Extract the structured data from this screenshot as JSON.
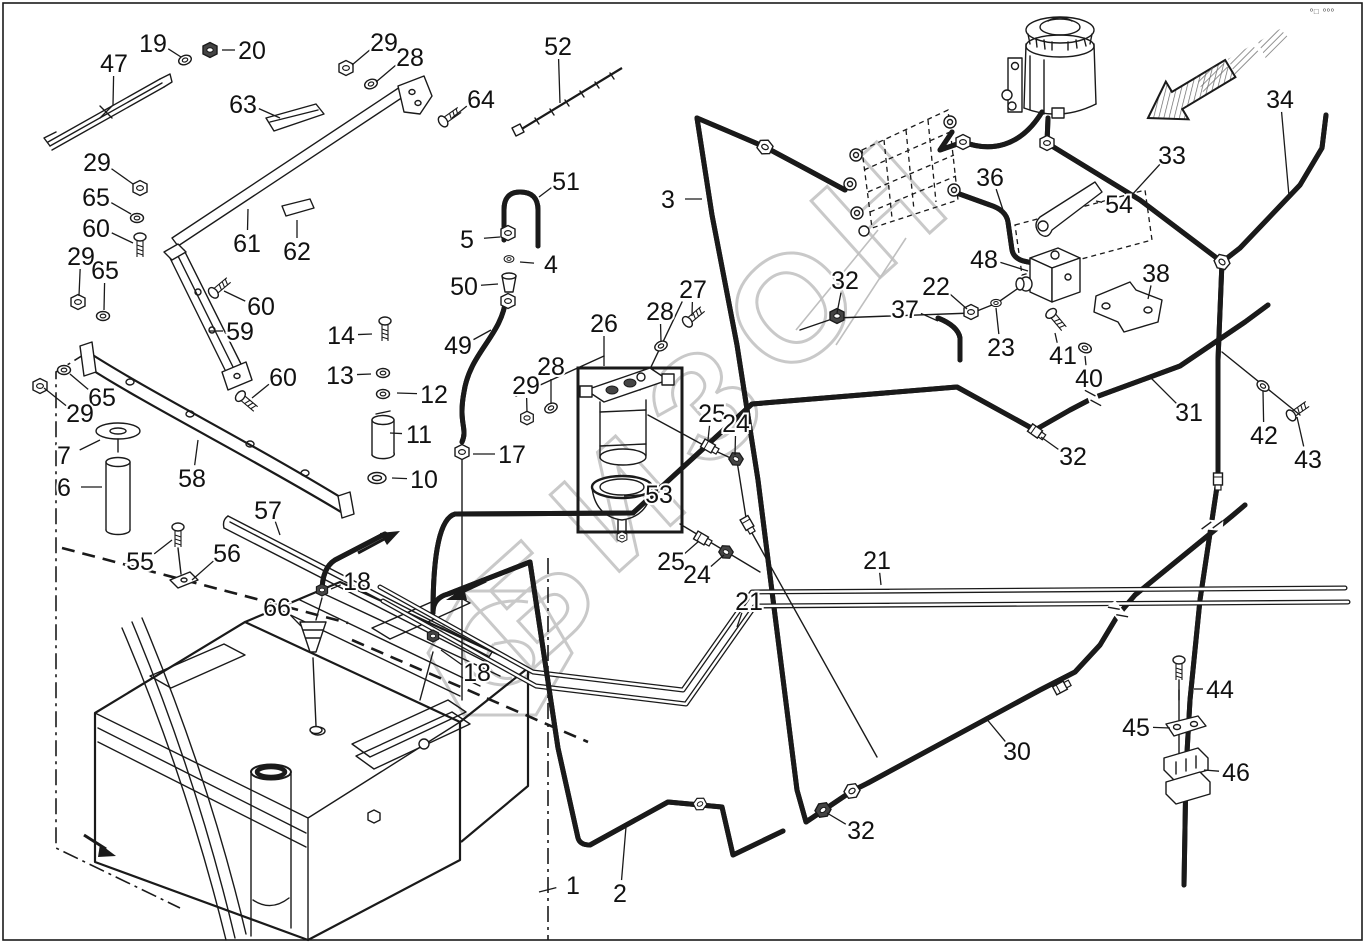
{
  "meta": {
    "watermark_text": "БИЗОН",
    "corner_mark": "º□ ººº",
    "diagram_type": "exploded-parts-diagram",
    "subject": "fuel-tank-and-hydraulic-lines"
  },
  "colors": {
    "line": "#1a1a1a",
    "watermark": "#c9c9c9",
    "background": "#ffffff"
  },
  "callouts": [
    {
      "label": "19",
      "x": 153,
      "y": 43,
      "tx": 181,
      "ty": 57
    },
    {
      "label": "20",
      "x": 252,
      "y": 50,
      "tx": 222,
      "ty": 50
    },
    {
      "label": "47",
      "x": 114,
      "y": 63,
      "tx": 113,
      "ty": 105
    },
    {
      "label": "29",
      "x": 384,
      "y": 42,
      "tx": 352,
      "ty": 65
    },
    {
      "label": "28",
      "x": 410,
      "y": 57,
      "tx": 376,
      "ty": 82
    },
    {
      "label": "63",
      "x": 243,
      "y": 104,
      "tx": 280,
      "ty": 118
    },
    {
      "label": "64",
      "x": 481,
      "y": 99,
      "tx": 452,
      "ty": 118
    },
    {
      "label": "52",
      "x": 558,
      "y": 46,
      "tx": 560,
      "ty": 103
    },
    {
      "label": "34",
      "x": 1280,
      "y": 99,
      "tx": 1289,
      "ty": 196
    },
    {
      "label": "33",
      "x": 1172,
      "y": 155,
      "tx": 1130,
      "ty": 197
    },
    {
      "label": "36",
      "x": 990,
      "y": 177,
      "tx": 1004,
      "ty": 213
    },
    {
      "label": "54",
      "x": 1119,
      "y": 204,
      "tx": 1096,
      "ty": 201
    },
    {
      "label": "3",
      "x": 668,
      "y": 199,
      "tx": 702,
      "ty": 199
    },
    {
      "label": "29",
      "x": 97,
      "y": 162,
      "tx": 133,
      "ty": 184
    },
    {
      "label": "65",
      "x": 96,
      "y": 197,
      "tx": 131,
      "ty": 214
    },
    {
      "label": "60",
      "x": 96,
      "y": 228,
      "tx": 133,
      "ty": 243
    },
    {
      "label": "29",
      "x": 81,
      "y": 256,
      "tx": 79,
      "ty": 296
    },
    {
      "label": "65",
      "x": 105,
      "y": 270,
      "tx": 104,
      "ty": 310
    },
    {
      "label": "60",
      "x": 261,
      "y": 306,
      "tx": 224,
      "ty": 291
    },
    {
      "label": "59",
      "x": 240,
      "y": 331,
      "tx": 209,
      "ty": 331
    },
    {
      "label": "60",
      "x": 283,
      "y": 377,
      "tx": 252,
      "ty": 398
    },
    {
      "label": "61",
      "x": 247,
      "y": 243,
      "tx": 248,
      "ty": 209
    },
    {
      "label": "62",
      "x": 297,
      "y": 251,
      "tx": 297,
      "ty": 220
    },
    {
      "label": "5",
      "x": 467,
      "y": 239,
      "tx": 500,
      "ty": 237
    },
    {
      "label": "4",
      "x": 551,
      "y": 264,
      "tx": 520,
      "ty": 262
    },
    {
      "label": "50",
      "x": 464,
      "y": 286,
      "tx": 498,
      "ty": 284
    },
    {
      "label": "49",
      "x": 458,
      "y": 345,
      "tx": 491,
      "ty": 330
    },
    {
      "label": "51",
      "x": 566,
      "y": 181,
      "tx": 539,
      "ty": 197
    },
    {
      "label": "14",
      "x": 341,
      "y": 335,
      "tx": 372,
      "ty": 334
    },
    {
      "label": "13",
      "x": 340,
      "y": 375,
      "tx": 371,
      "ty": 374
    },
    {
      "label": "12",
      "x": 434,
      "y": 394,
      "tx": 397,
      "ty": 393
    },
    {
      "label": "11",
      "x": 419,
      "y": 434,
      "tx": 390,
      "ty": 433
    },
    {
      "label": "10",
      "x": 424,
      "y": 479,
      "tx": 392,
      "ty": 478
    },
    {
      "label": "17",
      "x": 512,
      "y": 454,
      "tx": 473,
      "ty": 454
    },
    {
      "label": "26",
      "x": 604,
      "y": 323,
      "tx": 604,
      "ty": 366
    },
    {
      "label": "28",
      "x": 660,
      "y": 311,
      "tx": 661,
      "ty": 342
    },
    {
      "label": "27",
      "x": 693,
      "y": 289,
      "tx": 692,
      "ty": 316
    },
    {
      "label": "29",
      "x": 526,
      "y": 385,
      "tx": 527,
      "ty": 412
    },
    {
      "label": "28",
      "x": 551,
      "y": 366,
      "tx": 551,
      "ty": 404
    },
    {
      "label": "65",
      "x": 102,
      "y": 397,
      "tx": 70,
      "ty": 374
    },
    {
      "label": "29",
      "x": 80,
      "y": 413,
      "tx": 44,
      "ty": 388
    },
    {
      "label": "7",
      "x": 64,
      "y": 455,
      "tx": 100,
      "ty": 440
    },
    {
      "label": "6",
      "x": 64,
      "y": 487,
      "tx": 102,
      "ty": 487
    },
    {
      "label": "58",
      "x": 192,
      "y": 478,
      "tx": 198,
      "ty": 440
    },
    {
      "label": "57",
      "x": 268,
      "y": 510,
      "tx": 280,
      "ty": 535
    },
    {
      "label": "55",
      "x": 140,
      "y": 561,
      "tx": 172,
      "ty": 540
    },
    {
      "label": "56",
      "x": 227,
      "y": 553,
      "tx": 192,
      "ty": 580
    },
    {
      "label": "18",
      "x": 357,
      "y": 581,
      "tx": 331,
      "ty": 589
    },
    {
      "label": "66",
      "x": 277,
      "y": 607,
      "tx": 301,
      "ty": 626
    },
    {
      "label": "18",
      "x": 477,
      "y": 672,
      "tx": 441,
      "ty": 650
    },
    {
      "label": "25",
      "x": 712,
      "y": 413,
      "tx": 708,
      "ty": 440
    },
    {
      "label": "24",
      "x": 736,
      "y": 423,
      "tx": 735,
      "ty": 455
    },
    {
      "label": "53",
      "x": 659,
      "y": 494,
      "tx": 624,
      "ty": 496
    },
    {
      "label": "25",
      "x": 671,
      "y": 561,
      "tx": 699,
      "ty": 541
    },
    {
      "label": "24",
      "x": 697,
      "y": 574,
      "tx": 724,
      "ty": 555
    },
    {
      "label": "21",
      "x": 877,
      "y": 560,
      "tx": 881,
      "ty": 585
    },
    {
      "label": "21",
      "x": 749,
      "y": 601,
      "tx": 737,
      "ty": 627
    },
    {
      "label": "32",
      "x": 845,
      "y": 280,
      "tx": 837,
      "ty": 313
    },
    {
      "label": "22",
      "x": 936,
      "y": 286,
      "tx": 967,
      "ty": 309
    },
    {
      "label": "37",
      "x": 905,
      "y": 309,
      "tx": 938,
      "ty": 321
    },
    {
      "label": "23",
      "x": 1001,
      "y": 347,
      "tx": 996,
      "ty": 308
    },
    {
      "label": "41",
      "x": 1063,
      "y": 355,
      "tx": 1055,
      "ty": 333
    },
    {
      "label": "40",
      "x": 1089,
      "y": 378,
      "tx": 1085,
      "ty": 356
    },
    {
      "label": "38",
      "x": 1156,
      "y": 273,
      "tx": 1148,
      "ty": 299
    },
    {
      "label": "48",
      "x": 984,
      "y": 259,
      "tx": 1028,
      "ty": 271
    },
    {
      "label": "31",
      "x": 1189,
      "y": 412,
      "tx": 1151,
      "ty": 378
    },
    {
      "label": "32",
      "x": 1073,
      "y": 456,
      "tx": 1041,
      "ty": 437
    },
    {
      "label": "42",
      "x": 1264,
      "y": 435,
      "tx": 1263,
      "ty": 391
    },
    {
      "label": "43",
      "x": 1308,
      "y": 459,
      "tx": 1297,
      "ty": 417
    },
    {
      "label": "30",
      "x": 1017,
      "y": 751,
      "tx": 985,
      "ty": 717
    },
    {
      "label": "32",
      "x": 861,
      "y": 830,
      "tx": 827,
      "ty": 813
    },
    {
      "label": "44",
      "x": 1220,
      "y": 689,
      "tx": 1194,
      "ty": 689
    },
    {
      "label": "45",
      "x": 1136,
      "y": 727,
      "tx": 1170,
      "ty": 728
    },
    {
      "label": "46",
      "x": 1236,
      "y": 772,
      "tx": 1204,
      "ty": 770
    },
    {
      "label": "1",
      "x": 573,
      "y": 885,
      "tx": 539,
      "ty": 892
    },
    {
      "label": "2",
      "x": 620,
      "y": 893,
      "tx": 626,
      "ty": 827
    }
  ]
}
